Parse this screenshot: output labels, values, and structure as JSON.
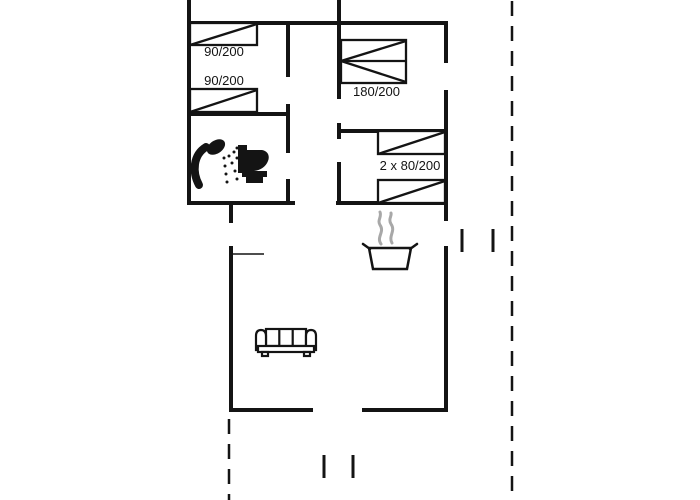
{
  "page": {
    "type": "floor-plan-drawing",
    "background": "#ffffff"
  },
  "plan": {
    "wall_color": "#141414",
    "steam_color": "#a8a8a8",
    "boundary_style": "dashed",
    "labels": {
      "bed_single_top": "90/200",
      "bed_single_bottom": "90/200",
      "bed_double": "180/200",
      "bed_bunks": "2 x 80/200"
    },
    "rooms": [
      {
        "name": "bedroom-top-left",
        "furniture": [
          "single-bed",
          "single-bed"
        ]
      },
      {
        "name": "bedroom-top-middle",
        "furniture": [
          "double-bed"
        ]
      },
      {
        "name": "bedroom-right",
        "furniture": [
          "single-bed",
          "single-bed"
        ]
      },
      {
        "name": "bathroom",
        "furniture": [
          "shower",
          "toilet"
        ]
      },
      {
        "name": "kitchen",
        "furniture": [
          "cooking-pot"
        ]
      },
      {
        "name": "living-room",
        "furniture": [
          "sofa"
        ]
      }
    ],
    "icons": [
      "shower-icon",
      "toilet-icon",
      "cooking-pot-icon",
      "steam-icon",
      "sofa-icon"
    ]
  }
}
